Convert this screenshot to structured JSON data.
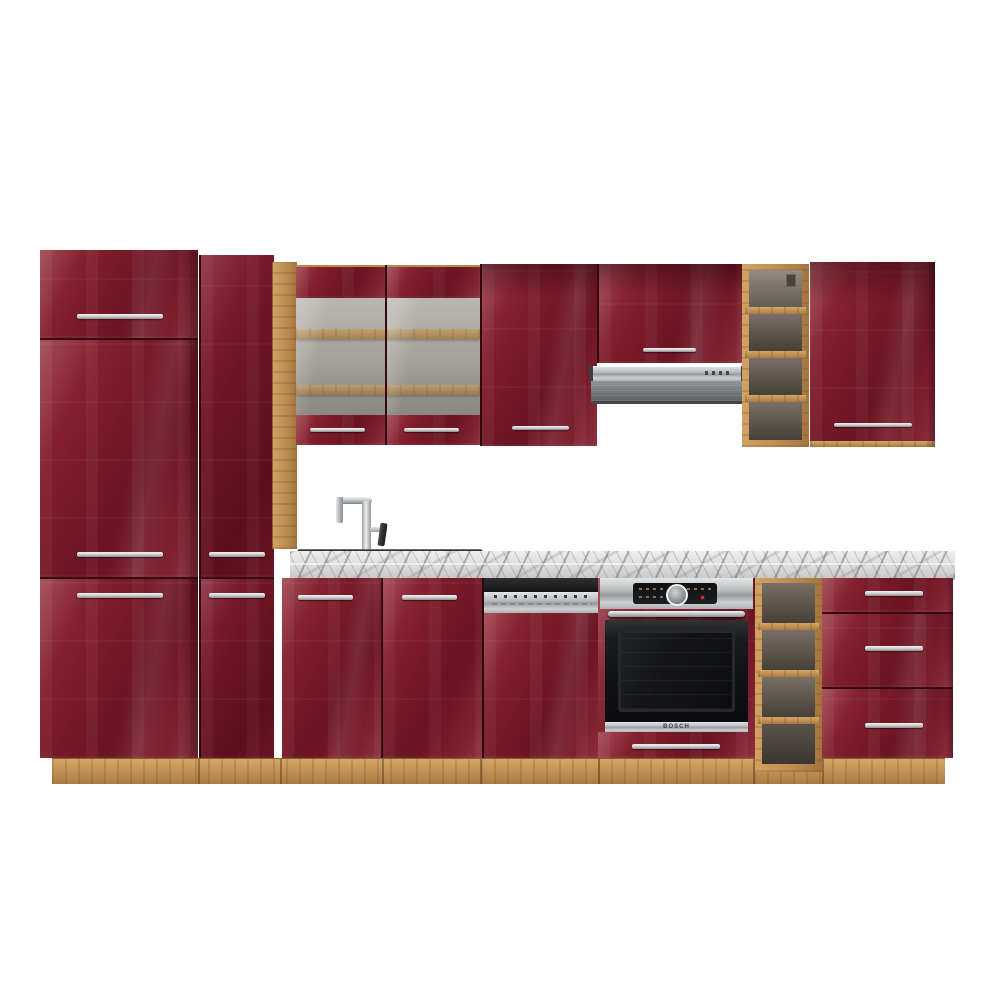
{
  "scene": {
    "description": "Product photo of a complete kitchen cabinet set in burgundy (bordeaux) high-gloss with oak carcass, plinth and open shelf units, on a white background",
    "background": "#ffffff"
  },
  "colors": {
    "burgundy": "#7a1a28",
    "burgundy_dark": "#5d0e1c",
    "burgundy_highlight": "#96303e",
    "oak": "#bd8c50",
    "oak_dark": "#a3753e",
    "marble_top": "#dadad8",
    "stainless": "#b9bdbf",
    "chrome": "#d2d2d2",
    "appliance_black": "#141518",
    "glass_interior": "#b1aaa2"
  },
  "components": {
    "tall_cabinet_left": {
      "label": "Tall fridge-housing cabinet, 3 doors with chrome bar handles"
    },
    "tall_cabinet_pantry": {
      "label": "Tall pantry cabinet, 2 doors with chrome bar handles"
    },
    "oak_side_panel": {
      "label": "Oak side panel"
    },
    "wall_cabinet_glass": {
      "label": "Double glass-door wall cabinet with two oak shelves"
    },
    "wall_cabinet_solid": {
      "label": "Single-door wall cabinet"
    },
    "hood_cabinet": {
      "label": "Short wall cabinet above extractor hood"
    },
    "wall_shelf_unit": {
      "label": "Open oak wall shelf, 4 compartments"
    },
    "wall_cabinet_right": {
      "label": "Single-door wall cabinet, right end"
    },
    "base_cabinet_sink": {
      "label": "Sink base cabinet, 2 doors"
    },
    "base_shelf_unit": {
      "label": "Open oak base shelf, 4 compartments"
    },
    "drawer_cabinet": {
      "label": "Base cabinet with 3 drawers"
    },
    "countertop": {
      "label": "Grey marble-effect worktop"
    },
    "plinth": {
      "label": "Oak plinth"
    }
  },
  "appliances": {
    "range_hood": {
      "label": "Stainless slide-out extractor hood"
    },
    "dishwasher": {
      "label": "Semi-integrated dishwasher with stainless control panel"
    },
    "oven": {
      "label": "Built-in oven, stainless and black glass",
      "brand_label": "BOSCH"
    },
    "sink": {
      "label": "Black inset sink"
    },
    "faucet": {
      "label": "Chrome high-arc mixer tap"
    }
  }
}
